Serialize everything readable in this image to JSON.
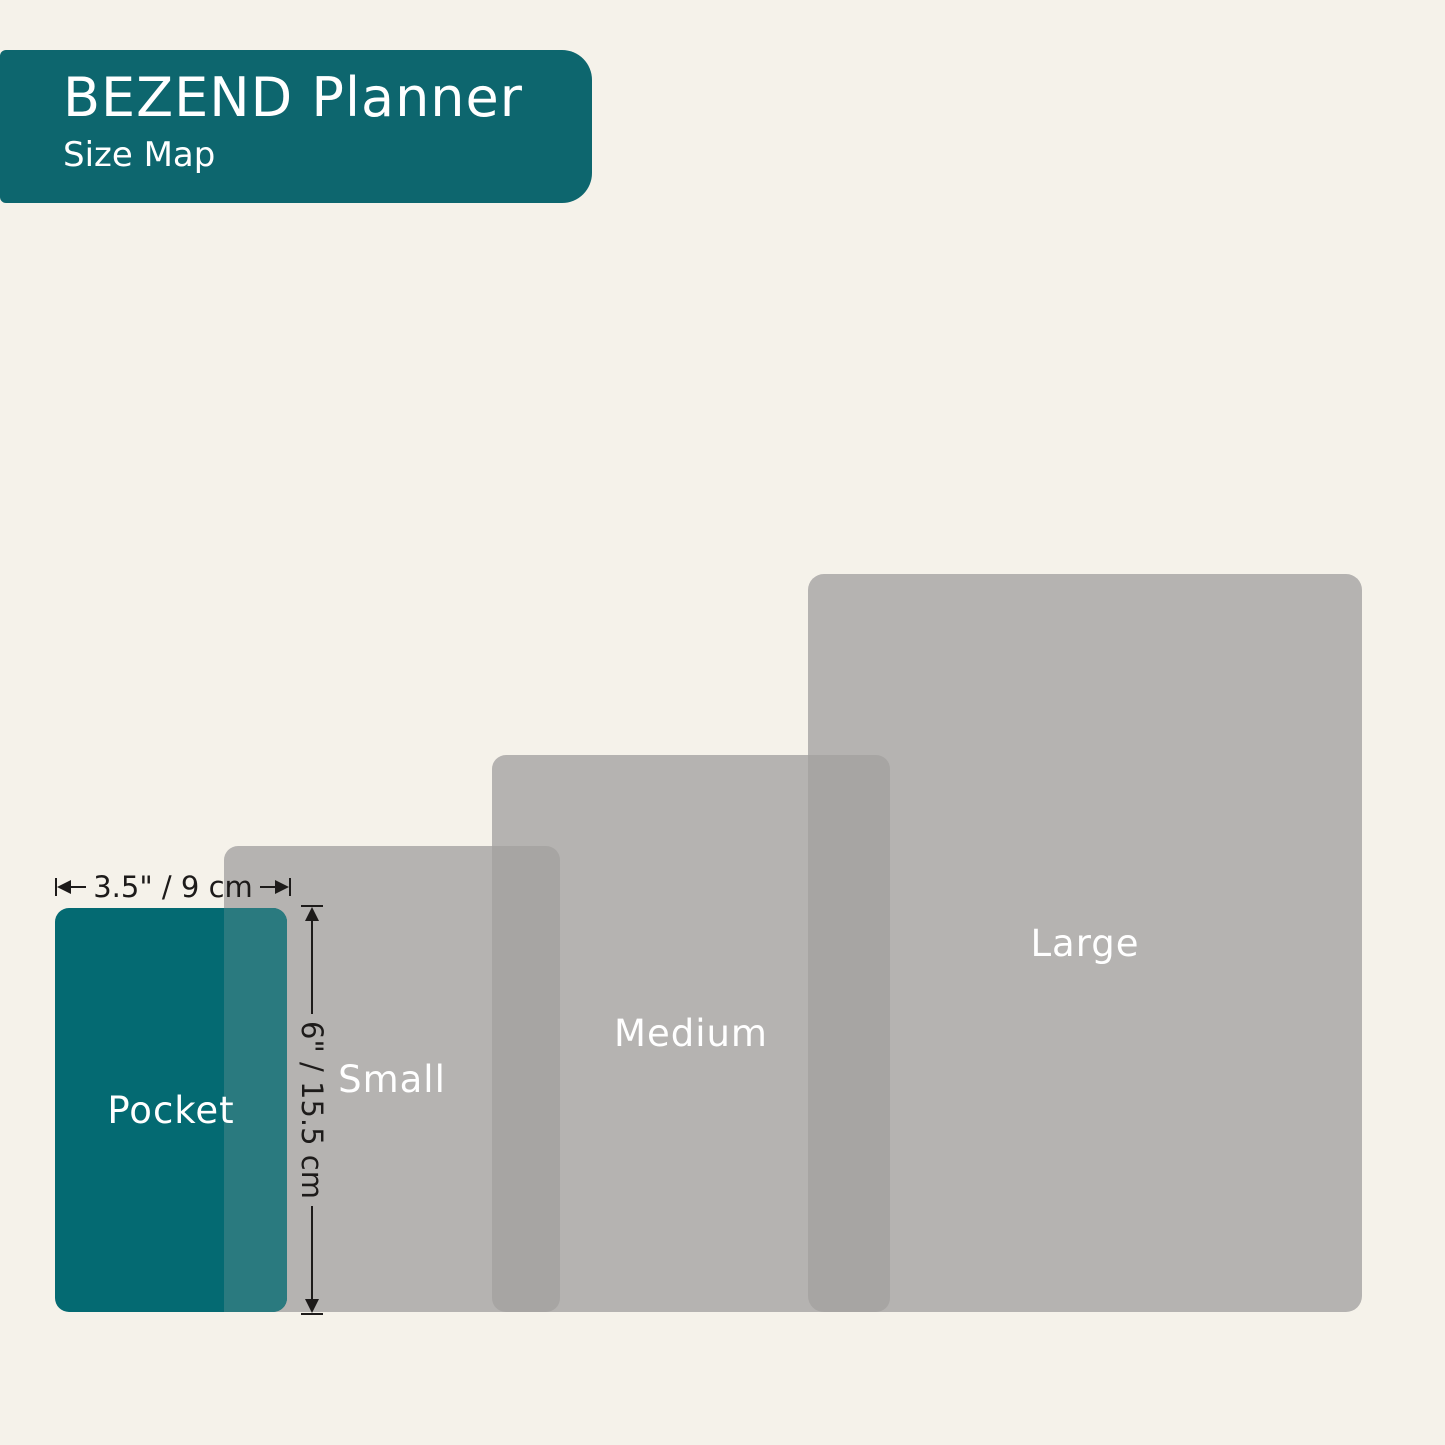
{
  "header": {
    "title": "BEZEND Planner",
    "subtitle": "Size Map"
  },
  "sizes": [
    {
      "label": "Pocket"
    },
    {
      "label": "Small"
    },
    {
      "label": "Medium"
    },
    {
      "label": "Large"
    }
  ],
  "dimensions": {
    "width_label": "3.5\" / 9 cm",
    "height_label": "6\" / 15.5 cm"
  },
  "colors": {
    "bg": "#f5f2ea",
    "banner": "#0d666e",
    "pocket": "#046a72",
    "gray-single": "#b5b3b1",
    "gray-overlap": "#a7a5a3",
    "teal-overlap": "#2a7a7f",
    "dim": "#1d1b1a",
    "label": "#ffffff"
  }
}
